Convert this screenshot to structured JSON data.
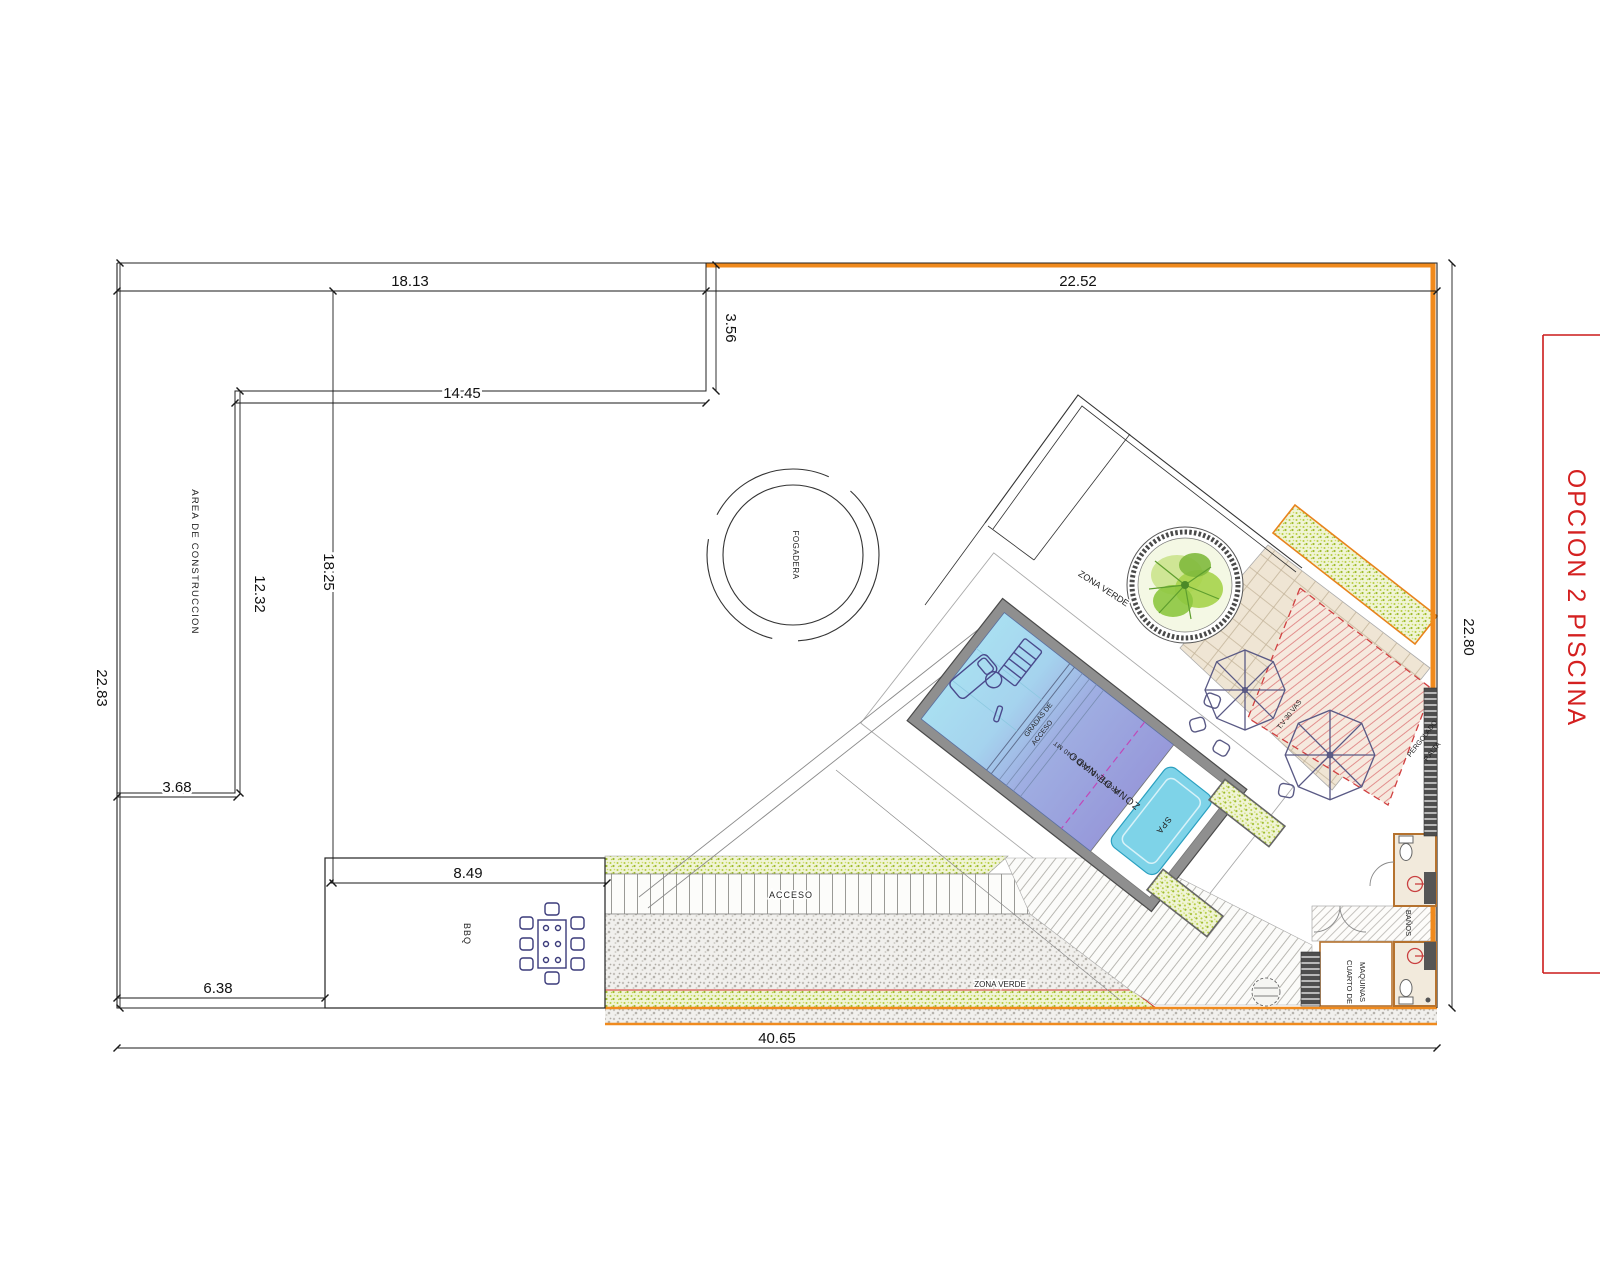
{
  "drawing": {
    "title": "OPCION 2 PISCINA",
    "dimensions": {
      "top_width": "18.13",
      "setback_height": "3.56",
      "inner_width": "14.45",
      "top_right_width": "22.52",
      "left_height": "22.83",
      "inner_left_height": "12.32",
      "mid_height": "18.25",
      "left_step_width": "3.68",
      "bbq_width": "8.49",
      "bottom_left_width": "6.38",
      "total_width": "40.65",
      "right_height": "22.80"
    },
    "labels": {
      "construction_area": "AREA DE CONSTRUCCION",
      "fire_pit": "FOGADERA",
      "green_zone_upper": "ZONA VERDE",
      "green_zone_lower": "ZONA VERDE",
      "walkway_access": "ACCESO",
      "bbq": "BBQ",
      "pool_steps_line1": "GRADAS DE",
      "pool_steps_line2": "ACCESO",
      "swim_depth": "PROFUNDIDAD 1.40 MT",
      "swim_zone": "ZONA DE NADO",
      "spa": "SPA",
      "terrace_note": "T.V 30 VAS",
      "pergola_line1": "PERGOLADO",
      "pergola_line2": "P.ALTA",
      "machine_room_line1": "CUARTO DE",
      "machine_room_line2": "MAQUINAS",
      "bathrooms": "BAÑOS"
    },
    "colors": {
      "boundary_orange": "#F08A1D",
      "title_red": "#D42020",
      "pool_shallow": "#A9DFF1",
      "pool_deep": "#9799DA",
      "spa_water": "#7ED3E8",
      "planter_green": "#BCD24A",
      "tree_green": "#8DC63F",
      "pergola_hatch_red": "#D04040",
      "furniture_blue": "#4A4A8C",
      "terrace_beige": "#EFE5D4"
    }
  }
}
